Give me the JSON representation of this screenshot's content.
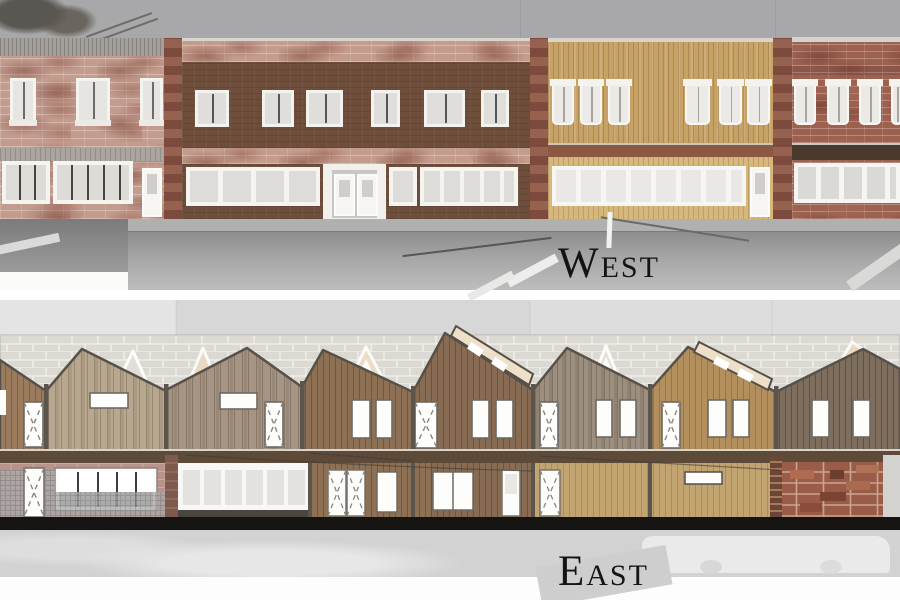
{
  "title": "Street elevation drawings",
  "labels": {
    "west": "West",
    "east": "East"
  },
  "west_elevation": {
    "name": "West elevation photomontage",
    "label": "West",
    "buildings": [
      {
        "id": "left-pink-brick-building",
        "material": "mottled pink brick",
        "color": "#c39c8e",
        "upper_windows": 3,
        "storefront_groups": 2,
        "doors": 1
      },
      {
        "id": "dark-brown-brick-building",
        "material": "dark brown brick with pink brick bands",
        "color": "#6e4e3b",
        "upper_windows": 6,
        "storefront_groups": 3,
        "entrance": "recessed double door"
      },
      {
        "id": "tan-wood-building",
        "material": "vertical tan wood planks",
        "color": "#c7a266",
        "upper_windows": 6,
        "storefront_panes": 8,
        "doors": 1
      },
      {
        "id": "red-brick-building",
        "material": "red brick",
        "color": "#9d6150",
        "upper_windows": 4,
        "storefront_panes": 5
      }
    ]
  },
  "east_elevation": {
    "name": "East elevation photomontage",
    "label": "East",
    "background": "white brick wall",
    "gabled_units": 8,
    "unit_colors": [
      "#9b7b5d",
      "#b7a78e",
      "#a69584",
      "#8e7154",
      "#876b52",
      "#9c8f7f",
      "#b28f5c",
      "#7d6e5e"
    ]
  },
  "palette": {
    "sky_gray": "#a8a8aa",
    "street_gray": "#a6a6a6",
    "white_brick": "#dcd9d3",
    "fascia_brown": "#5d4a39",
    "ground_line": "#141212",
    "label_color": "#141414",
    "page_background": "#ffffff"
  }
}
